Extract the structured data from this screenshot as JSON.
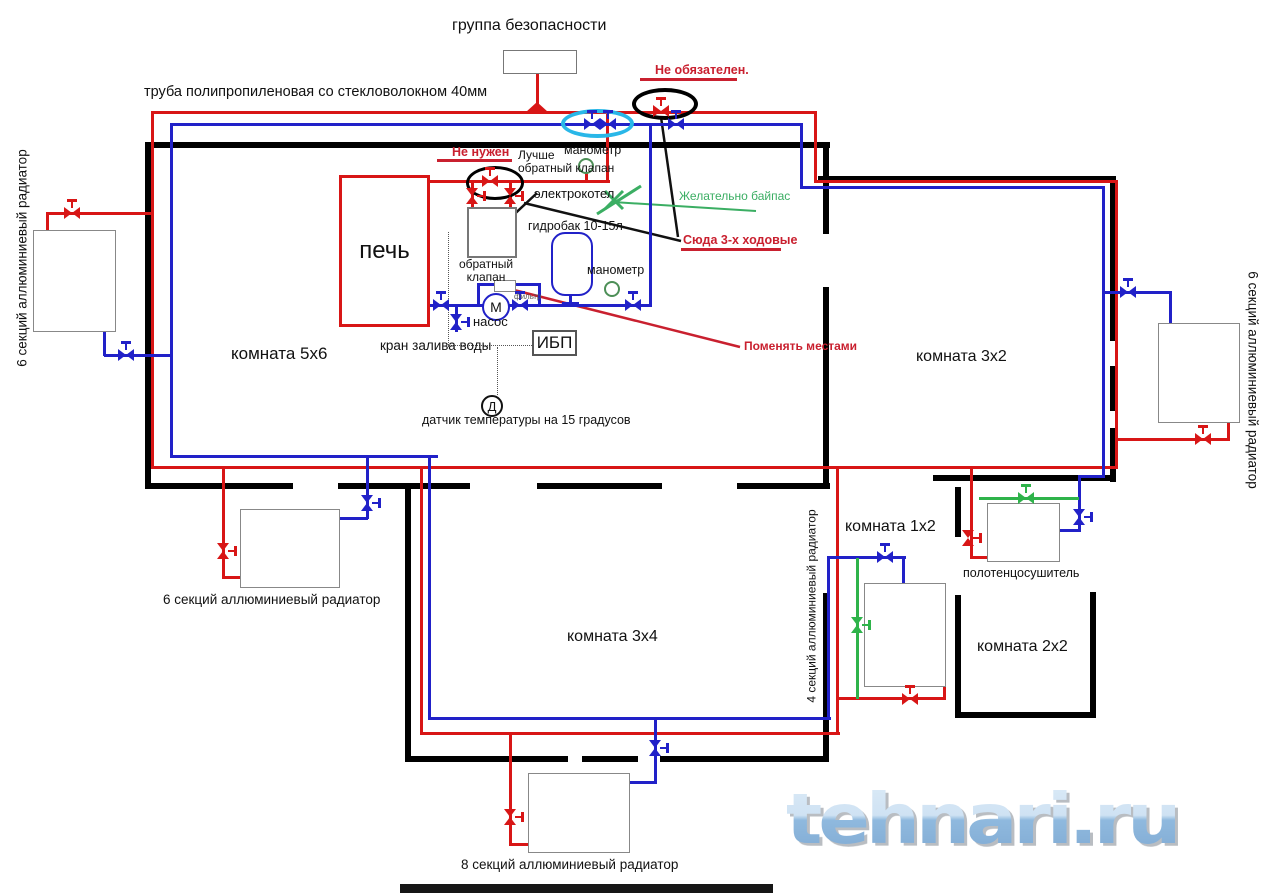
{
  "colors": {
    "red": "#d81616",
    "blue": "#2121c8",
    "green": "#2eb34a",
    "ared": "#c9202f",
    "green2": "#3bae63"
  },
  "watermark": {
    "text": "tehnari.ru"
  },
  "labels": [
    {
      "n": "label-title",
      "t": "группа безопасности",
      "x": 452,
      "y": 17,
      "fs": 16
    },
    {
      "n": "label-pipe-type",
      "t": "труба полипропиленовая со стекловолокном 40мм",
      "x": 144,
      "y": 84,
      "fs": 14.5
    },
    {
      "n": "label-not-required",
      "t": "Не обязателен.",
      "x": 655,
      "y": 63,
      "fs": 12.5,
      "c": "ared",
      "b": 1
    },
    {
      "n": "label-not-needed",
      "t": "Не нужен",
      "x": 452,
      "y": 145,
      "fs": 12.5,
      "c": "ared",
      "b": 1
    },
    {
      "n": "label-better-check-valve",
      "t": "Лучше\nобратный клапан",
      "x": 518,
      "y": 149,
      "fs": 12
    },
    {
      "n": "label-gauge-1",
      "t": "манометр",
      "x": 564,
      "y": 143,
      "fs": 12.5
    },
    {
      "n": "label-boiler",
      "t": "электрокотел",
      "x": 534,
      "y": 187,
      "fs": 13
    },
    {
      "n": "label-tank",
      "t": "гидробак 10-15л",
      "x": 528,
      "y": 219,
      "fs": 12.5
    },
    {
      "n": "label-check-valve",
      "t": "обратный\nклапан",
      "x": 455,
      "y": 258,
      "fs": 12,
      "al": "center",
      "wd": 62
    },
    {
      "n": "label-gauge-2",
      "t": "манометр",
      "x": 587,
      "y": 263,
      "fs": 12.5
    },
    {
      "n": "label-filter",
      "t": "фильтр",
      "x": 514,
      "y": 293,
      "fs": 8,
      "hex": "#555555"
    },
    {
      "n": "label-pump",
      "t": "насос",
      "x": 473,
      "y": 315,
      "fs": 13
    },
    {
      "n": "label-fill-valve",
      "t": "кран залива воды",
      "x": 380,
      "y": 338,
      "fs": 13.5
    },
    {
      "n": "label-sensor",
      "t": "датчик температуры на 15 градусов",
      "x": 422,
      "y": 413,
      "fs": 12.5
    },
    {
      "n": "label-room-5x6",
      "t": "комната 5х6",
      "x": 231,
      "y": 344,
      "fs": 17
    },
    {
      "n": "label-bypass",
      "t": "Желательно байпас",
      "x": 679,
      "y": 190,
      "fs": 12,
      "c": "green2"
    },
    {
      "n": "label-3way",
      "t": "Сюда 3-х ходовые",
      "x": 683,
      "y": 233,
      "fs": 12.5,
      "c": "ared",
      "b": 1
    },
    {
      "n": "label-swap",
      "t": "Поменять местами",
      "x": 744,
      "y": 340,
      "fs": 12,
      "c": "ared",
      "b": 1
    },
    {
      "n": "label-room-3x2",
      "t": "комната 3х2",
      "x": 916,
      "y": 348,
      "fs": 16
    },
    {
      "n": "label-room-1x2",
      "t": "комната 1х2",
      "x": 845,
      "y": 518,
      "fs": 16
    },
    {
      "n": "label-towel",
      "t": "полотенцосушитель",
      "x": 963,
      "y": 566,
      "fs": 12.5
    },
    {
      "n": "label-room-2x2",
      "t": "комната 2х2",
      "x": 977,
      "y": 638,
      "fs": 16
    },
    {
      "n": "label-room-3x4",
      "t": "комната 3х4",
      "x": 567,
      "y": 628,
      "fs": 16
    },
    {
      "n": "label-radiator-left",
      "t": "6 секций аллюминиевый радиатор",
      "x": 22,
      "y": 258,
      "fs": 13.5,
      "rot": -90
    },
    {
      "n": "label-radiator-right",
      "t": "6 секций аллюминиевый радиатор",
      "x": 1253,
      "y": 380,
      "fs": 13.5,
      "rot": 90
    },
    {
      "n": "label-radiator-bottom-left",
      "t": "6 секций аллюминиевый радиатор",
      "x": 163,
      "y": 592,
      "fs": 13.5
    },
    {
      "n": "label-radiator-4sec",
      "t": "4 секций аллюминиевый радиатор",
      "x": 812,
      "y": 606,
      "fs": 12,
      "rot": -90
    },
    {
      "n": "label-radiator-8sec",
      "t": "8 секций аллюминиевый радиатор",
      "x": 461,
      "y": 857,
      "fs": 13.5
    }
  ],
  "walls": [
    {
      "x": 145,
      "y": 142,
      "w": 685,
      "h": 6
    },
    {
      "x": 818,
      "y": 176,
      "w": 297,
      "h": 6
    },
    {
      "x": 145,
      "y": 142,
      "w": 6,
      "h": 347
    },
    {
      "x": 823,
      "y": 142,
      "w": 6,
      "h": 92
    },
    {
      "x": 823,
      "y": 287,
      "w": 6,
      "h": 200
    },
    {
      "x": 1110,
      "y": 176,
      "w": 6,
      "h": 165
    },
    {
      "x": 1110,
      "y": 366,
      "w": 6,
      "h": 45
    },
    {
      "x": 1110,
      "y": 428,
      "w": 6,
      "h": 54
    },
    {
      "x": 933,
      "y": 475,
      "w": 183,
      "h": 6
    },
    {
      "x": 145,
      "y": 483,
      "w": 148,
      "h": 6
    },
    {
      "x": 338,
      "y": 483,
      "w": 132,
      "h": 6
    },
    {
      "x": 537,
      "y": 483,
      "w": 125,
      "h": 6
    },
    {
      "x": 737,
      "y": 483,
      "w": 93,
      "h": 6
    },
    {
      "x": 405,
      "y": 487,
      "w": 6,
      "h": 272
    },
    {
      "x": 405,
      "y": 756,
      "w": 163,
      "h": 6
    },
    {
      "x": 582,
      "y": 756,
      "w": 56,
      "h": 6
    },
    {
      "x": 660,
      "y": 756,
      "w": 169,
      "h": 6
    },
    {
      "x": 823,
      "y": 593,
      "w": 6,
      "h": 169
    },
    {
      "x": 955,
      "y": 487,
      "w": 6,
      "h": 50
    },
    {
      "x": 955,
      "y": 595,
      "w": 6,
      "h": 120
    },
    {
      "x": 955,
      "y": 712,
      "w": 140,
      "h": 6
    },
    {
      "x": 1090,
      "y": 592,
      "w": 6,
      "h": 126
    }
  ],
  "pipes": [
    {
      "n": "pipe-red-top-main",
      "c": "red",
      "x": 152,
      "y": 111,
      "w": 664,
      "h": 3
    },
    {
      "c": "red",
      "x": 814,
      "y": 111,
      "w": 3,
      "h": 71
    },
    {
      "c": "red",
      "x": 814,
      "y": 180,
      "w": 304,
      "h": 3
    },
    {
      "c": "red",
      "x": 1115,
      "y": 180,
      "w": 3,
      "h": 289
    },
    {
      "c": "red",
      "x": 151,
      "y": 111,
      "w": 3,
      "h": 358
    },
    {
      "c": "red",
      "x": 47,
      "y": 212,
      "w": 106,
      "h": 3
    },
    {
      "c": "red",
      "x": 46,
      "y": 212,
      "w": 3,
      "h": 20
    },
    {
      "n": "pipe-red-bottom-main",
      "c": "red",
      "x": 151,
      "y": 466,
      "w": 967,
      "h": 3
    },
    {
      "c": "red",
      "x": 222,
      "y": 468,
      "w": 3,
      "h": 110
    },
    {
      "c": "red",
      "x": 222,
      "y": 576,
      "w": 20,
      "h": 3
    },
    {
      "c": "red",
      "x": 420,
      "y": 468,
      "w": 3,
      "h": 267
    },
    {
      "c": "red",
      "x": 420,
      "y": 732,
      "w": 420,
      "h": 3
    },
    {
      "c": "red",
      "x": 509,
      "y": 734,
      "w": 3,
      "h": 111
    },
    {
      "c": "red",
      "x": 509,
      "y": 843,
      "w": 22,
      "h": 3
    },
    {
      "c": "red",
      "x": 836,
      "y": 468,
      "w": 3,
      "h": 267
    },
    {
      "c": "red",
      "x": 836,
      "y": 697,
      "w": 110,
      "h": 3
    },
    {
      "c": "red",
      "x": 943,
      "y": 686,
      "w": 3,
      "h": 14
    },
    {
      "c": "red",
      "x": 970,
      "y": 467,
      "w": 3,
      "h": 92
    },
    {
      "c": "red",
      "x": 970,
      "y": 556,
      "w": 19,
      "h": 3
    },
    {
      "c": "red",
      "x": 1118,
      "y": 438,
      "w": 112,
      "h": 3
    },
    {
      "c": "red",
      "x": 1227,
      "y": 423,
      "w": 3,
      "h": 18
    },
    {
      "c": "red",
      "x": 430,
      "y": 180,
      "w": 180,
      "h": 3
    },
    {
      "c": "red",
      "x": 606,
      "y": 111,
      "w": 3,
      "h": 72
    },
    {
      "c": "red",
      "x": 471,
      "y": 183,
      "w": 3,
      "h": 26
    },
    {
      "c": "red",
      "x": 509,
      "y": 183,
      "w": 3,
      "h": 26
    },
    {
      "c": "red",
      "x": 536,
      "y": 74,
      "w": 3,
      "h": 30
    },
    {
      "c": "red",
      "x": 585,
      "y": 173,
      "w": 3,
      "h": 9
    },
    {
      "n": "pipe-blue-top-main",
      "c": "blue",
      "x": 171,
      "y": 123,
      "w": 632,
      "h": 3
    },
    {
      "c": "blue",
      "x": 800,
      "y": 123,
      "w": 3,
      "h": 66
    },
    {
      "c": "blue",
      "x": 800,
      "y": 186,
      "w": 305,
      "h": 3
    },
    {
      "c": "blue",
      "x": 1102,
      "y": 186,
      "w": 3,
      "h": 292
    },
    {
      "c": "blue",
      "x": 1080,
      "y": 475,
      "w": 25,
      "h": 3
    },
    {
      "c": "blue",
      "x": 1078,
      "y": 475,
      "w": 3,
      "h": 57
    },
    {
      "c": "blue",
      "x": 1059,
      "y": 529,
      "w": 22,
      "h": 3
    },
    {
      "c": "blue",
      "x": 170,
      "y": 123,
      "w": 3,
      "h": 335
    },
    {
      "c": "blue",
      "x": 104,
      "y": 354,
      "w": 68,
      "h": 3
    },
    {
      "c": "blue",
      "x": 103,
      "y": 332,
      "w": 3,
      "h": 24
    },
    {
      "c": "blue",
      "x": 170,
      "y": 455,
      "w": 268,
      "h": 3
    },
    {
      "c": "blue",
      "x": 428,
      "y": 455,
      "w": 3,
      "h": 265
    },
    {
      "c": "blue",
      "x": 428,
      "y": 717,
      "w": 403,
      "h": 3
    },
    {
      "c": "blue",
      "x": 366,
      "y": 457,
      "w": 3,
      "h": 62
    },
    {
      "c": "blue",
      "x": 340,
      "y": 517,
      "w": 28,
      "h": 3
    },
    {
      "c": "blue",
      "x": 654,
      "y": 718,
      "w": 3,
      "h": 66
    },
    {
      "c": "blue",
      "x": 630,
      "y": 781,
      "w": 27,
      "h": 3
    },
    {
      "c": "blue",
      "x": 827,
      "y": 556,
      "w": 3,
      "h": 163
    },
    {
      "c": "blue",
      "x": 827,
      "y": 556,
      "w": 79,
      "h": 3
    },
    {
      "c": "blue",
      "x": 902,
      "y": 556,
      "w": 3,
      "h": 29
    },
    {
      "n": "pipe-pump-line",
      "c": "blue",
      "x": 430,
      "y": 304,
      "w": 222,
      "h": 3
    },
    {
      "c": "blue",
      "x": 649,
      "y": 124,
      "w": 3,
      "h": 182
    },
    {
      "c": "blue",
      "x": 477,
      "y": 284,
      "w": 3,
      "h": 22
    },
    {
      "c": "blue",
      "x": 538,
      "y": 284,
      "w": 3,
      "h": 22
    },
    {
      "c": "blue",
      "x": 477,
      "y": 283,
      "w": 64,
      "h": 3
    },
    {
      "c": "blue",
      "x": 569,
      "y": 295,
      "w": 3,
      "h": 9
    },
    {
      "c": "blue",
      "x": 562,
      "y": 302,
      "w": 17,
      "h": 4
    },
    {
      "c": "blue",
      "x": 455,
      "y": 307,
      "w": 3,
      "h": 25
    },
    {
      "c": "blue",
      "x": 1103,
      "y": 291,
      "w": 69,
      "h": 3
    },
    {
      "c": "blue",
      "x": 1169,
      "y": 291,
      "w": 3,
      "h": 33
    },
    {
      "n": "pipe-green-towel-bypass",
      "c": "green",
      "x": 979,
      "y": 497,
      "w": 100,
      "h": 3
    },
    {
      "n": "pipe-green-radiator-bypass",
      "c": "green",
      "x": 856,
      "y": 558,
      "w": 3,
      "h": 141
    },
    {
      "n": "underline-not-required",
      "c": "ared",
      "x": 640,
      "y": 78,
      "w": 97,
      "h": 3
    },
    {
      "n": "underline-not-needed",
      "c": "ared",
      "x": 437,
      "y": 159,
      "w": 75,
      "h": 3
    },
    {
      "n": "underline-3way",
      "c": "ared",
      "x": 681,
      "y": 248,
      "w": 100,
      "h": 3
    }
  ],
  "valves": [
    {
      "c": "red",
      "x": 72,
      "y": 213,
      "o": "h"
    },
    {
      "c": "red",
      "x": 490,
      "y": 181,
      "o": "h"
    },
    {
      "c": "red",
      "x": 661,
      "y": 111,
      "o": "h"
    },
    {
      "c": "red",
      "x": 472,
      "y": 196,
      "o": "v"
    },
    {
      "c": "red",
      "x": 510,
      "y": 196,
      "o": "v"
    },
    {
      "c": "red",
      "x": 223,
      "y": 551,
      "o": "v"
    },
    {
      "c": "red",
      "x": 510,
      "y": 817,
      "o": "v"
    },
    {
      "c": "red",
      "x": 910,
      "y": 699,
      "o": "h"
    },
    {
      "c": "red",
      "x": 968,
      "y": 538,
      "o": "v"
    },
    {
      "c": "red",
      "x": 1203,
      "y": 439,
      "o": "h"
    },
    {
      "c": "blue",
      "x": 592,
      "y": 124,
      "o": "h"
    },
    {
      "c": "blue",
      "x": 608,
      "y": 124,
      "o": "h"
    },
    {
      "c": "blue",
      "x": 676,
      "y": 124,
      "o": "h"
    },
    {
      "c": "blue",
      "x": 126,
      "y": 355,
      "o": "h"
    },
    {
      "c": "blue",
      "x": 441,
      "y": 305,
      "o": "h"
    },
    {
      "c": "blue",
      "x": 520,
      "y": 305,
      "o": "h"
    },
    {
      "c": "blue",
      "x": 633,
      "y": 305,
      "o": "h"
    },
    {
      "c": "blue",
      "x": 456,
      "y": 322,
      "o": "v"
    },
    {
      "c": "blue",
      "x": 367,
      "y": 503,
      "o": "v"
    },
    {
      "c": "blue",
      "x": 655,
      "y": 748,
      "o": "v"
    },
    {
      "c": "blue",
      "x": 885,
      "y": 557,
      "o": "h"
    },
    {
      "c": "blue",
      "x": 1128,
      "y": 292,
      "o": "h"
    },
    {
      "c": "blue",
      "x": 1079,
      "y": 517,
      "o": "v"
    },
    {
      "c": "green",
      "x": 857,
      "y": 625,
      "o": "v"
    },
    {
      "c": "green",
      "x": 1026,
      "y": 498,
      "o": "h"
    }
  ],
  "boxes": [
    {
      "n": "safety-group-box",
      "x": 503,
      "y": 50,
      "w": 74,
      "h": 24,
      "bc": "#777",
      "bw": 1
    },
    {
      "n": "furnace-box",
      "x": 339,
      "y": 175,
      "w": 91,
      "h": 152,
      "bc": "#d81616",
      "bw": 3,
      "label": "печь",
      "fs": 24
    },
    {
      "n": "electric-boiler-box",
      "x": 467,
      "y": 207,
      "w": 50,
      "h": 51,
      "bc": "#777",
      "bw": 2
    },
    {
      "n": "expansion-tank-box",
      "x": 551,
      "y": 232,
      "w": 42,
      "h": 64,
      "bc": "#2121c8",
      "bw": 2,
      "r": 14
    },
    {
      "n": "ups-box",
      "x": 532,
      "y": 330,
      "w": 45,
      "h": 26,
      "bc": "#555",
      "bw": 2,
      "label": "ИБП",
      "fs": 17
    },
    {
      "n": "check-valve-box",
      "x": 494,
      "y": 280,
      "w": 22,
      "h": 12,
      "bc": "#888",
      "bw": 1
    },
    {
      "n": "radiator-box-left",
      "x": 33,
      "y": 230,
      "w": 83,
      "h": 102,
      "bc": "#888",
      "bw": 1
    },
    {
      "n": "radiator-box-bottom-left",
      "x": 240,
      "y": 509,
      "w": 100,
      "h": 79,
      "bc": "#888",
      "bw": 1
    },
    {
      "n": "radiator-box-right",
      "x": 1158,
      "y": 323,
      "w": 82,
      "h": 100,
      "bc": "#888",
      "bw": 1
    },
    {
      "n": "radiator-box-4sec",
      "x": 864,
      "y": 583,
      "w": 82,
      "h": 104,
      "bc": "#888",
      "bw": 1
    },
    {
      "n": "towel-dryer-box",
      "x": 987,
      "y": 503,
      "w": 73,
      "h": 59,
      "bc": "#888",
      "bw": 1
    },
    {
      "n": "radiator-box-8sec",
      "x": 528,
      "y": 773,
      "w": 102,
      "h": 80,
      "bc": "#888",
      "bw": 1
    }
  ],
  "circles": [
    {
      "n": "pump-circle",
      "x": 482,
      "y": 293,
      "d": 28,
      "bc": "#2121c8",
      "bw": 2,
      "label": "М",
      "fs": 14
    },
    {
      "n": "gauge-circle-top",
      "x": 578,
      "y": 158,
      "d": 16,
      "bc": "#4d8f57",
      "bw": 2
    },
    {
      "n": "gauge-circle-mid",
      "x": 604,
      "y": 281,
      "d": 16,
      "bc": "#4d8f57",
      "bw": 2
    },
    {
      "n": "temp-sensor-circle",
      "x": 481,
      "y": 395,
      "d": 22,
      "bc": "#111",
      "bw": 2,
      "label": "Д",
      "fs": 13
    }
  ],
  "ellipses": [
    {
      "n": "annotation-ellipse-black-1",
      "x": 466,
      "y": 166,
      "w": 58,
      "h": 34,
      "bc": "#000",
      "bw": 3
    },
    {
      "n": "annotation-ellipse-black-2",
      "x": 632,
      "y": 88,
      "w": 66,
      "h": 32,
      "bc": "#000",
      "bw": 4
    },
    {
      "n": "annotation-ellipse-cyan",
      "x": 561,
      "y": 109,
      "w": 73,
      "h": 29,
      "bc": "#29b7e8",
      "bw": 4
    }
  ],
  "lines": [
    {
      "n": "pointer-boiler-label",
      "c": "#111",
      "w": 2.5,
      "x1": 537,
      "y1": 193,
      "x2": 491,
      "y2": 236
    },
    {
      "n": "pointer-3way-left",
      "c": "#111",
      "w": 2.5,
      "x1": 524,
      "y1": 203,
      "x2": 681,
      "y2": 241
    },
    {
      "n": "pointer-3way-top",
      "c": "#111",
      "w": 2.5,
      "x1": 661,
      "y1": 117,
      "x2": 678,
      "y2": 237
    },
    {
      "n": "pointer-swap",
      "c": "#c9202f",
      "w": 2.5,
      "x1": 510,
      "y1": 289,
      "x2": 740,
      "y2": 347
    },
    {
      "n": "pointer-bypass",
      "c": "#3bae63",
      "w": 2,
      "x1": 613,
      "y1": 202,
      "x2": 756,
      "y2": 211
    },
    {
      "n": "green-3way-valve-diag",
      "c": "#3bae63",
      "w": 3,
      "x1": 597,
      "y1": 214,
      "x2": 641,
      "y2": 186
    },
    {
      "n": "green-3way-valve-x1",
      "c": "#3bae63",
      "w": 3,
      "x1": 605,
      "y1": 191,
      "x2": 623,
      "y2": 209
    },
    {
      "n": "green-3way-valve-x2",
      "c": "#3bae63",
      "w": 3,
      "x1": 623,
      "y1": 191,
      "x2": 605,
      "y2": 209
    }
  ],
  "dotted": [
    {
      "x": 448,
      "y": 232,
      "w": 0,
      "h": 115
    },
    {
      "x": 448,
      "y": 345,
      "w": 84,
      "h": 0
    },
    {
      "x": 497,
      "y": 347,
      "w": 0,
      "h": 48
    }
  ]
}
